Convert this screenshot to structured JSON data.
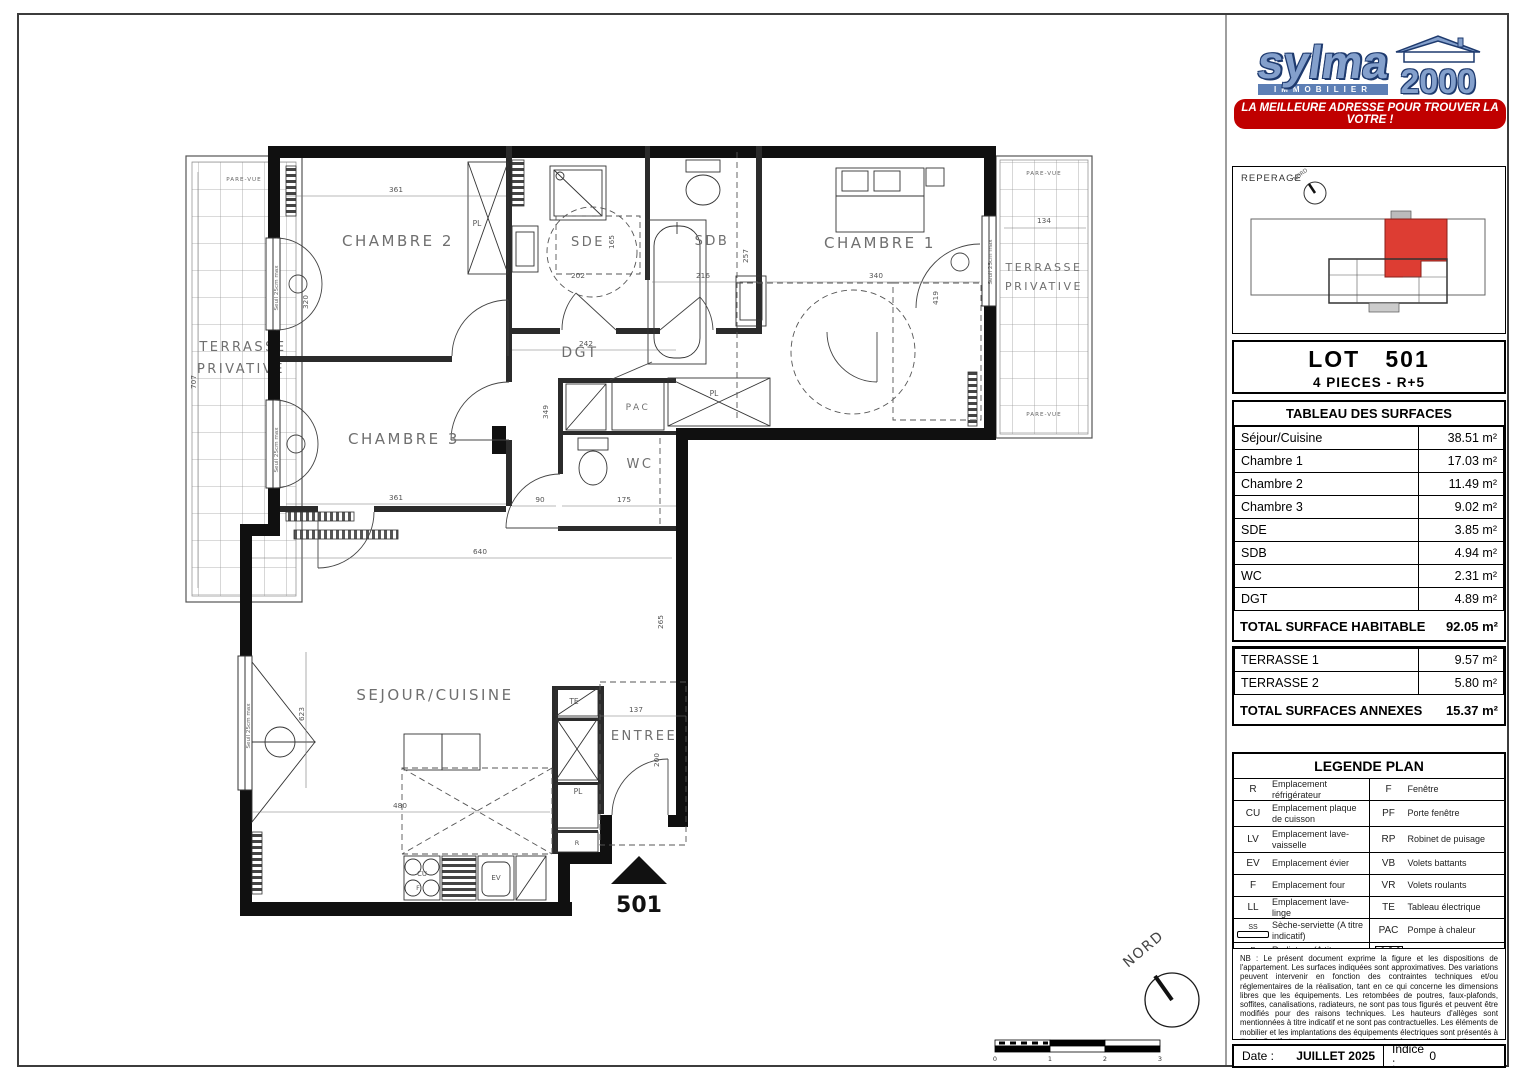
{
  "plan": {
    "rooms": {
      "chambre2": "CHAMBRE 2",
      "sde": "SDE",
      "sdb": "SDB",
      "chambre1": "CHAMBRE 1",
      "chambre3": "CHAMBRE 3",
      "dgt": "DGT",
      "wc": "WC",
      "pac": "PAC",
      "sejour": "SEJOUR/CUISINE",
      "entree": "ENTREE"
    },
    "labels": {
      "pare_vue": "PARE-VUE",
      "terrasse": "TERRASSE",
      "privative": "PRIVATIVE",
      "seuil": "Seuil 25cm max",
      "nord": "NORD",
      "lot_marker": "501"
    },
    "fixtures": {
      "pl": "PL",
      "te": "TE",
      "r": "R",
      "cu": "CU",
      "f": "F",
      "ev": "EV"
    },
    "dims": {
      "c2_w": "361",
      "c2_win": "320",
      "sde_rect": "202",
      "sde_h": "165",
      "sdb_w": "216",
      "sdb_h": "257",
      "c1_w": "340",
      "c1_h": "419",
      "ter2_w": "134",
      "ter1_h": "707",
      "dgt_w": "242",
      "c3_w": "361",
      "c3_h": "349",
      "wc_a": "90",
      "wc_b": "175",
      "sej_w": "640",
      "sej_h": "623",
      "kit_w": "480",
      "ent_w": "137",
      "ent_h": "265",
      "ent_door": "200"
    },
    "scale_ticks": [
      "0",
      "1",
      "2",
      "3"
    ]
  },
  "sidebar": {
    "logo": {
      "name": "sylma",
      "sub": "IMMOBILIER",
      "year": "2000",
      "tagline": "LA MEILLEURE ADRESSE POUR TROUVER LA VOTRE !"
    },
    "reperage": {
      "label": "REPERAGE",
      "north": "NORD"
    },
    "lot": {
      "word": "LOT",
      "number": "501",
      "subtitle": "4 PIECES - R+5"
    },
    "surfaces": {
      "title": "TABLEAU DES SURFACES",
      "rows": [
        {
          "label": "Séjour/Cuisine",
          "value": "38.51 m²"
        },
        {
          "label": "Chambre 1",
          "value": "17.03 m²"
        },
        {
          "label": "Chambre 2",
          "value": "11.49 m²"
        },
        {
          "label": "Chambre 3",
          "value": "9.02 m²"
        },
        {
          "label": "SDE",
          "value": "3.85 m²"
        },
        {
          "label": "SDB",
          "value": "4.94 m²"
        },
        {
          "label": "WC",
          "value": "2.31 m²"
        },
        {
          "label": "DGT",
          "value": "4.89 m²"
        }
      ],
      "total_label": "TOTAL SURFACE HABITABLE",
      "total_value": "92.05 m²"
    },
    "annexes": {
      "rows": [
        {
          "label": "TERRASSE 1",
          "value": "9.57 m²"
        },
        {
          "label": "TERRASSE 2",
          "value": "5.80 m²"
        }
      ],
      "total_label": "TOTAL SURFACES ANNEXES",
      "total_value": "15.37 m²"
    },
    "legend": {
      "title": "LEGENDE PLAN",
      "left": [
        {
          "abbr": "R",
          "desc": "Emplacement réfrigérateur"
        },
        {
          "abbr": "CU",
          "desc": "Emplacement plaque de cuisson"
        },
        {
          "abbr": "LV",
          "desc": "Emplacement lave-vaisselle"
        },
        {
          "abbr": "EV",
          "desc": "Emplacement évier"
        },
        {
          "abbr": "F",
          "desc": "Emplacement four"
        },
        {
          "abbr": "LL",
          "desc": "Emplacement lave-linge"
        },
        {
          "abbr": "SS",
          "desc": "Sèche-serviette (A titre indicatif)"
        },
        {
          "abbr": "R",
          "desc": "Radiateur (A titre indicatif)"
        }
      ],
      "right": [
        {
          "abbr": "F",
          "desc": "Fenêtre"
        },
        {
          "abbr": "PF",
          "desc": "Porte fenêtre"
        },
        {
          "abbr": "RP",
          "desc": "Robinet de puisage"
        },
        {
          "abbr": "VB",
          "desc": "Volets battants"
        },
        {
          "abbr": "VR",
          "desc": "Volets roulants"
        },
        {
          "abbr": "TE",
          "desc": "Tableau électrique"
        },
        {
          "abbr": "PAC",
          "desc": "Pompe à chaleur"
        },
        {
          "abbr": "",
          "desc": "Faux - plafond"
        }
      ]
    },
    "nb": "NB : Le présent document exprime la figure et les dispositions de l'appartement. Les surfaces indiquées sont approximatives. Des variations peuvent intervenir en fonction des contraintes techniques et/ou réglementaires de la réalisation, tant en ce qui concerne les dimensions libres que les équipements. Les retombées de poutres, faux-plafonds, soffites, canalisations, radiateurs, ne sont pas tous figurés et peuvent être modifiés pour des raisons techniques. Les hauteurs d'allèges sont mentionnées à titre indicatif et ne sont pas contractuelles. Les éléments de mobilier et les implantations des équipements électriques sont présentés à titre indicatif et ne sont pas contractuels. Les éventuelles plantations dans les jardins privatifs ou espaces communs ne sont pas contractuelles.",
    "footer": {
      "date_label": "Date :",
      "date_value": "JUILLET 2025",
      "indice_label": "Indice :",
      "indice_value": "0"
    }
  }
}
